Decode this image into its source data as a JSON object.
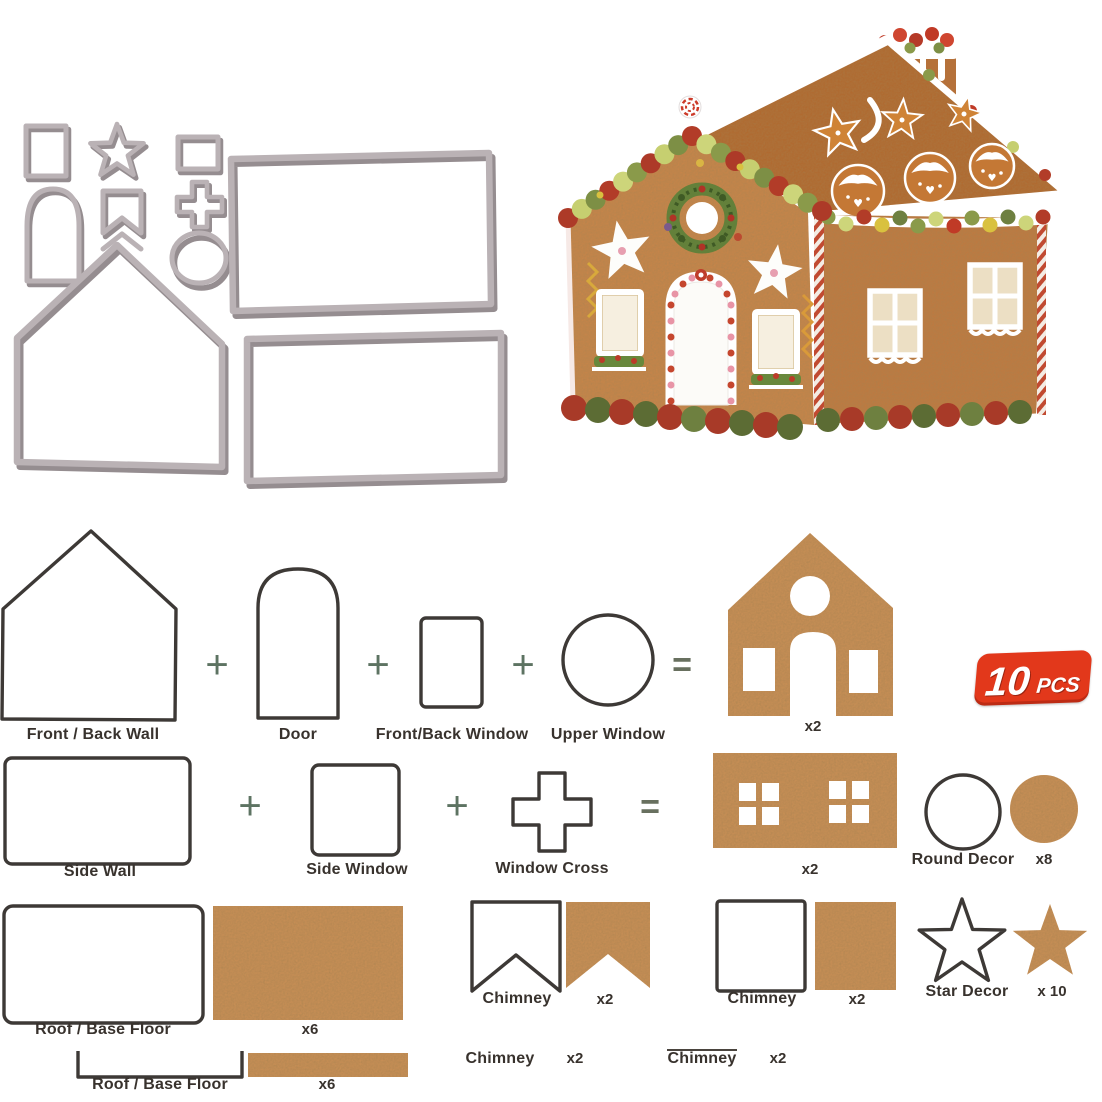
{
  "product": {
    "badge": {
      "count": "10",
      "unit": "PCS"
    }
  },
  "palette": {
    "badge_red": "#e2381b",
    "gingerbread": "#c68e55",
    "gingerbread_roof": "#b06a30",
    "icing_white": "#ffffff",
    "candy_red": "#b23c28",
    "candy_olive": "#7d8f45",
    "candy_light_green": "#c6cf70",
    "metal_gray": "#bab2b5",
    "outline_dark": "#3d3936",
    "operator_green": "#5d7362"
  },
  "equation1": {
    "shape1_label": "Front / Back Wall",
    "op1": "+",
    "shape2_label": "Door",
    "op2": "+",
    "shape3_label": "Front/Back Window",
    "op3": "+",
    "shape4_label": "Upper Window",
    "eq": "=",
    "result_count": "x2"
  },
  "equation2": {
    "shape1_label": "Side Wall",
    "op1": "+",
    "shape2_label": "Side Window",
    "op2": "+",
    "shape3_label": "Window Cross",
    "eq": "=",
    "result_count": "x2"
  },
  "extras": {
    "round_decor": {
      "label": "Round Decor",
      "count": "x8"
    },
    "star_decor": {
      "label": "Star Decor",
      "count": "x 10"
    }
  },
  "pieces": {
    "roof_large": {
      "label": "Roof / Base Floor",
      "count": "x6"
    },
    "chimney_notched": {
      "label": "Chimney",
      "count": "x2"
    },
    "chimney_square": {
      "label": "Chimney",
      "count": "x2"
    },
    "roof_bracket": {
      "label": "Roof / Base Floor",
      "count": "x6"
    },
    "chimney_notched_2": {
      "label": "Chimney",
      "count": "x2"
    },
    "chimney_square_2": {
      "label": "Chimney",
      "count": "x2"
    }
  }
}
